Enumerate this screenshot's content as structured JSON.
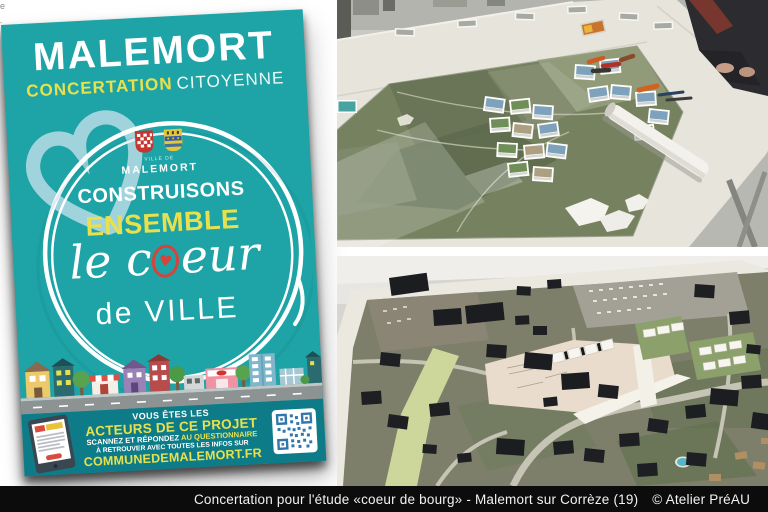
{
  "page": {
    "background": "#ffffff",
    "edge_fragments": [
      "e",
      "-"
    ]
  },
  "poster": {
    "title": "MALEMORT",
    "subtitle_primary": "CONCERTATION",
    "subtitle_secondary": "CITOYENNE",
    "crest_small": "VILLE DE",
    "crest_name": "MALEMORT",
    "line_construisons": "CONSTRUISONS",
    "line_ensemble": "ENSEMBLE",
    "script_prefix": "le c",
    "script_heart": "♥",
    "script_suffix": "eur",
    "line_ville": "de VILLE",
    "footer": {
      "line1": "VOUS ÊTES LES",
      "line2": "ACTEURS DE CE PROJET",
      "line3_white": "SCANNEZ ET RÉPONDEZ ",
      "line3_yellow": "AU QUESTIONNAIRE",
      "line4": "À RETROUVER AVEC TOUTES LES INFOS SUR",
      "line5": "COMMUNEDEMALEMORT.FR"
    }
  },
  "photos": {
    "workshop_table": "Workshop table with aerial map, photo cards, markers and rolled plan",
    "massing_model": "Architectural massing model, black volumes on aerial photo base"
  },
  "caption": {
    "text": "Concertation pour l'étude «coeur de bourg» - Malemort sur Corrèze (19)",
    "credit": "© Atelier PréAU"
  },
  "colors": {
    "poster_teal": "#1ea3a6",
    "poster_band_teal": "#0e7c88",
    "accent_yellow": "#e8e14d",
    "heart_red": "#d6433b",
    "pale_blue_heart": "#aed8e2",
    "qr_blue": "#3077ac",
    "caption_bg": "#0c0c0c",
    "caption_fg": "#f2f2f2"
  }
}
